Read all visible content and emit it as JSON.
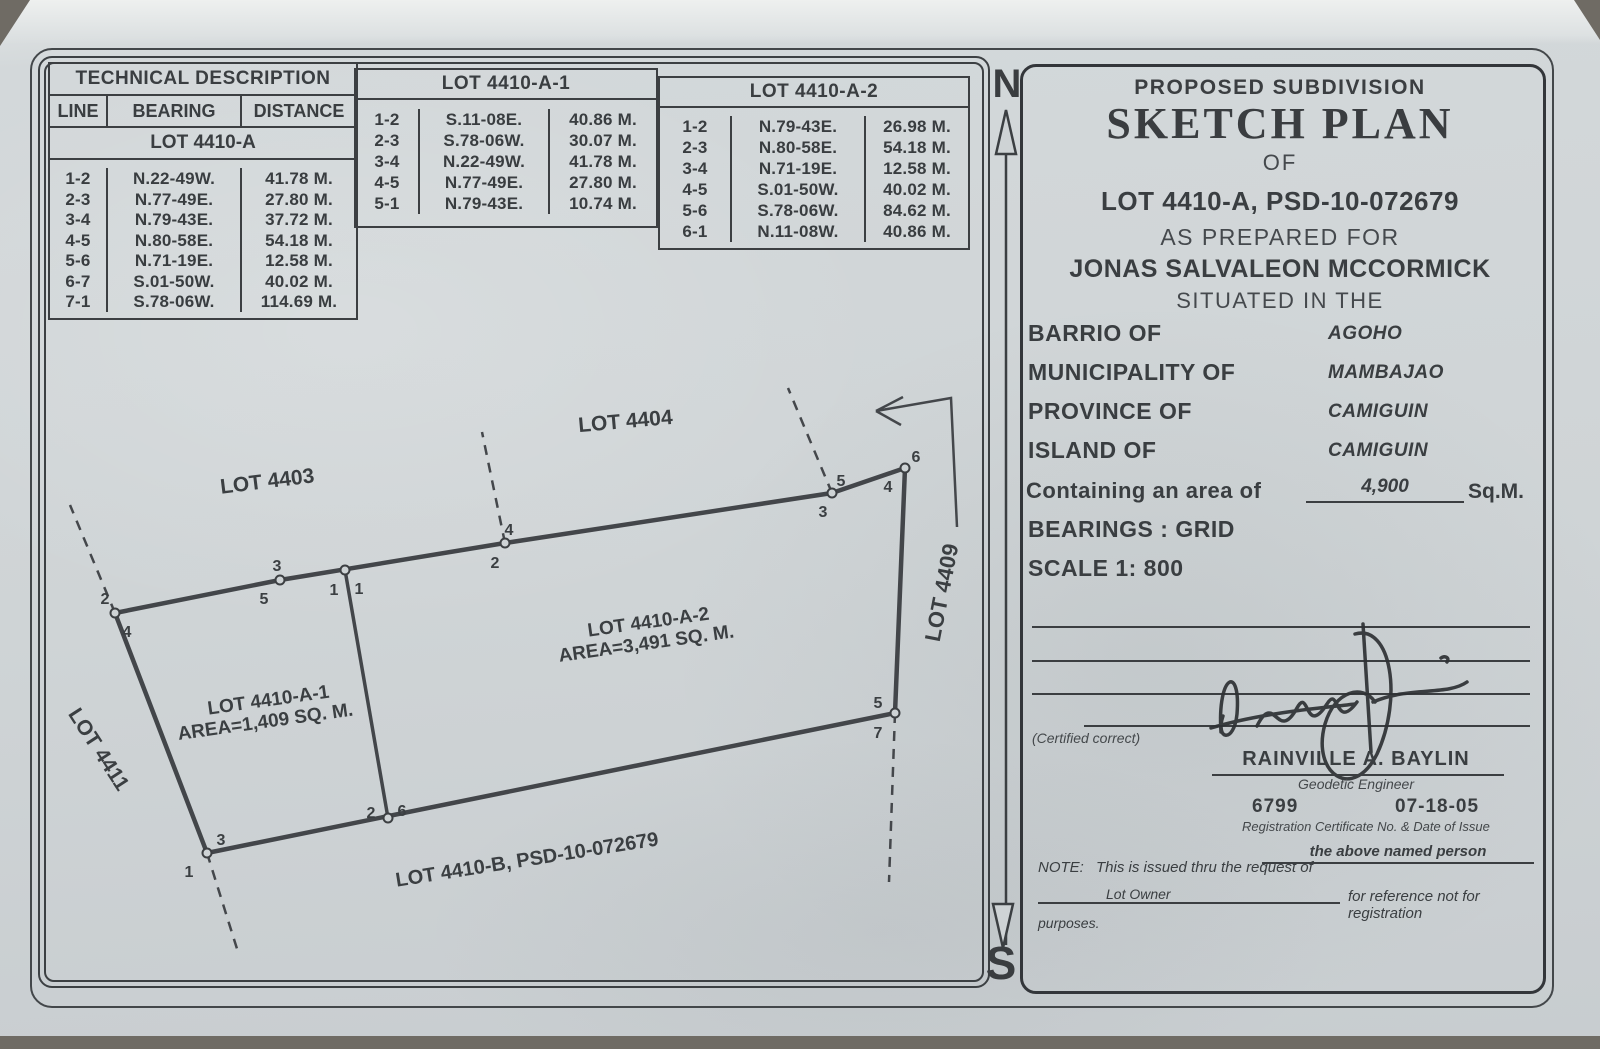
{
  "compass": {
    "north": "N",
    "south": "S"
  },
  "tables": {
    "main": {
      "title": "TECHNICAL DESCRIPTION",
      "columns": [
        "LINE",
        "BEARING",
        "DISTANCE"
      ],
      "subtitle": "LOT 4410-A",
      "rows": [
        [
          "1-2",
          "N.22-49W.",
          "41.78 M."
        ],
        [
          "2-3",
          "N.77-49E.",
          "27.80 M."
        ],
        [
          "3-4",
          "N.79-43E.",
          "37.72 M."
        ],
        [
          "4-5",
          "N.80-58E.",
          "54.18 M."
        ],
        [
          "5-6",
          "N.71-19E.",
          "12.58 M."
        ],
        [
          "6-7",
          "S.01-50W.",
          "40.02 M."
        ],
        [
          "7-1",
          "S.78-06W.",
          "114.69 M."
        ]
      ]
    },
    "lot_a1": {
      "title": "LOT 4410-A-1",
      "rows": [
        [
          "1-2",
          "S.11-08E.",
          "40.86 M."
        ],
        [
          "2-3",
          "S.78-06W.",
          "30.07 M."
        ],
        [
          "3-4",
          "N.22-49W.",
          "41.78 M."
        ],
        [
          "4-5",
          "N.77-49E.",
          "27.80 M."
        ],
        [
          "5-1",
          "N.79-43E.",
          "10.74 M."
        ]
      ]
    },
    "lot_a2": {
      "title": "LOT 4410-A-2",
      "rows": [
        [
          "1-2",
          "N.79-43E.",
          "26.98 M."
        ],
        [
          "2-3",
          "N.80-58E.",
          "54.18 M."
        ],
        [
          "3-4",
          "N.71-19E.",
          "12.58 M."
        ],
        [
          "4-5",
          "S.01-50W.",
          "40.02 M."
        ],
        [
          "5-6",
          "S.78-06W.",
          "84.62 M."
        ],
        [
          "6-1",
          "N.11-08W.",
          "40.86 M."
        ]
      ]
    }
  },
  "sketch": {
    "adjacent_lots": {
      "lot4403": "LOT 4403",
      "lot4404": "LOT 4404",
      "lot4409": "LOT 4409",
      "lot4411": "LOT 4411",
      "lot4410b": "LOT 4410-B, PSD-10-072679"
    },
    "parcel_a1": {
      "name": "LOT 4410-A-1",
      "area": "AREA=1,409 SQ. M."
    },
    "parcel_a2": {
      "name": "LOT 4410-A-2",
      "area": "AREA=3,491 SQ. M."
    },
    "vertex_labels": {
      "o1": "1",
      "o2": "2",
      "o3": "3",
      "o4": "4",
      "o5": "5",
      "o6": "6",
      "o7": "7",
      "a1_1": "1",
      "a1_2": "2",
      "a1_3": "3",
      "a1_4": "4",
      "a1_5": "5",
      "a2_1": "1",
      "a2_2": "2",
      "a2_3": "3",
      "a2_4": "4",
      "a2_5": "5",
      "a2_6": "6"
    }
  },
  "title_block": {
    "line1": "PROPOSED SUBDIVISION",
    "line2": "SKETCH PLAN",
    "line3": "OF",
    "lot_line": "LOT 4410-A, PSD-10-072679",
    "prepared": "AS PREPARED FOR",
    "owner": "JONAS SALVALEON MCCORMICK",
    "situated": "SITUATED IN THE",
    "fields": [
      {
        "label": "BARRIO OF",
        "value": "AGOHO"
      },
      {
        "label": "MUNICIPALITY OF",
        "value": "MAMBAJAO"
      },
      {
        "label": "PROVINCE OF",
        "value": "CAMIGUIN"
      },
      {
        "label": "ISLAND OF",
        "value": "CAMIGUIN"
      }
    ],
    "area_label": "Containing an area of",
    "area_value": "4,900",
    "area_unit": "Sq.M.",
    "bearings": "BEARINGS : GRID",
    "scale": "SCALE 1: 800",
    "certified": "(Certified correct)",
    "engineer_name": "RAINVILLE A. BAYLIN",
    "engineer_title": "Geodetic Engineer",
    "reg_no": "6799",
    "reg_date": "07-18-05",
    "reg_caption": "Registration Certificate No. & Date of Issue",
    "note_label": "NOTE:",
    "note_text": "This is issued thru the request of",
    "note_fill": "the above named person",
    "note_owner": "Lot Owner",
    "note_text2": "for reference not for registration",
    "note_text3": "purposes."
  }
}
